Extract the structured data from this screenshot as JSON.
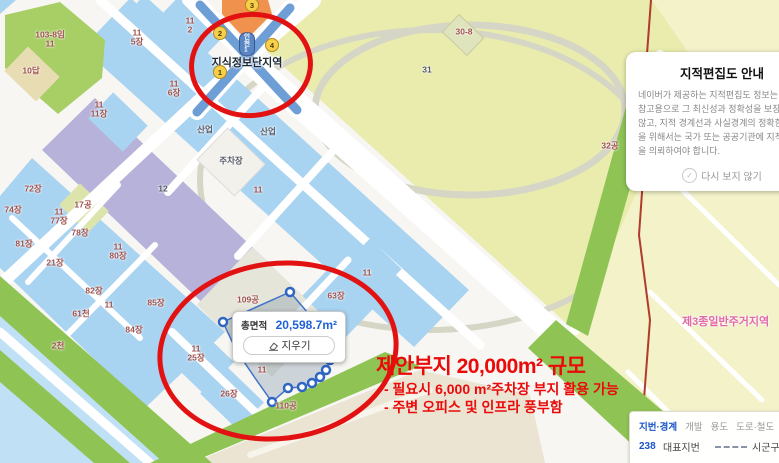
{
  "map": {
    "station": {
      "name": "지식정보단지역",
      "line_badge": "인천1",
      "exits": [
        {
          "n": "3",
          "x": 252,
          "y": 5
        },
        {
          "n": "2",
          "x": 220,
          "y": 33
        },
        {
          "n": "4",
          "x": 272,
          "y": 45
        },
        {
          "n": "1",
          "x": 220,
          "y": 72
        }
      ]
    },
    "zone_label": {
      "text": "제3종일반주거지역",
      "x": 682,
      "y": 313
    },
    "labels": [
      {
        "t": "103-8임\n11",
        "x": 50,
        "y": 40
      },
      {
        "t": "10답",
        "x": 31,
        "y": 71
      },
      {
        "t": "11\n5장",
        "x": 137,
        "y": 38
      },
      {
        "t": "11\n2",
        "x": 190,
        "y": 26
      },
      {
        "t": "11\n6장",
        "x": 174,
        "y": 89
      },
      {
        "t": "11\n11장",
        "x": 99,
        "y": 110
      },
      {
        "t": "12",
        "x": 163,
        "y": 189,
        "c": "dark"
      },
      {
        "t": "산업",
        "x": 205,
        "y": 130,
        "c": "dark"
      },
      {
        "t": "산업",
        "x": 268,
        "y": 132,
        "c": "dark"
      },
      {
        "t": "주차장",
        "x": 231,
        "y": 161,
        "c": "dark"
      },
      {
        "t": "11",
        "x": 258,
        "y": 190
      },
      {
        "t": "72장",
        "x": 33,
        "y": 189
      },
      {
        "t": "74장",
        "x": 13,
        "y": 210
      },
      {
        "t": "17공",
        "x": 83,
        "y": 205
      },
      {
        "t": "11\n77장",
        "x": 59,
        "y": 217
      },
      {
        "t": "78장",
        "x": 80,
        "y": 233
      },
      {
        "t": "81장",
        "x": 24,
        "y": 244
      },
      {
        "t": "21장",
        "x": 55,
        "y": 263
      },
      {
        "t": "11\n80장",
        "x": 118,
        "y": 252
      },
      {
        "t": "82장",
        "x": 94,
        "y": 291
      },
      {
        "t": "85장",
        "x": 156,
        "y": 303
      },
      {
        "t": "11",
        "x": 109,
        "y": 305
      },
      {
        "t": "84장",
        "x": 134,
        "y": 330
      },
      {
        "t": "61천",
        "x": 81,
        "y": 314
      },
      {
        "t": "2천",
        "x": 58,
        "y": 346
      },
      {
        "t": "109공",
        "x": 248,
        "y": 300
      },
      {
        "t": "63장",
        "x": 336,
        "y": 296
      },
      {
        "t": "11",
        "x": 367,
        "y": 273
      },
      {
        "t": "11\n25장",
        "x": 196,
        "y": 354
      },
      {
        "t": "11",
        "x": 262,
        "y": 370
      },
      {
        "t": "26장",
        "x": 229,
        "y": 394
      },
      {
        "t": "110공",
        "x": 286,
        "y": 406
      },
      {
        "t": "30-8",
        "x": 464,
        "y": 32
      },
      {
        "t": "31",
        "x": 427,
        "y": 70,
        "c": "dark"
      },
      {
        "t": "32공",
        "x": 610,
        "y": 146
      }
    ]
  },
  "measure_tooltip": {
    "area_label": "총면적",
    "area_value": "20,598.7m²",
    "clear_label": "지우기"
  },
  "proposal_note": {
    "title": "제안부지 20,000m² 규모",
    "bullets": [
      "- 필요시 6,000 m²주차장 부지 활용 가능",
      "- 주변 오피스 및 인프라 풍부함"
    ]
  },
  "notice_panel": {
    "title": "지적편집도 안내",
    "body": "네이버가 제공하는 지적편집도 정보는 단순 참고용으로 그 최신성과 정확성을 보장하지 않고, 지적 경계선과 사실경계의 정확한 확인을 위해서는 국가 또는 공공기관에 지적측량을 의뢰하여야 합니다.",
    "dismiss_label": "다시 보지 않기"
  },
  "legend_panel": {
    "tabs": [
      "지번·경계",
      "개발",
      "용도",
      "도로·철도",
      "국토계획"
    ],
    "active_tab_index": 0,
    "rows": [
      {
        "num": "238",
        "num_color": "#1a56c9",
        "label": "대표지번",
        "line_style": "dashed",
        "line_color": "#8a93a6",
        "line_label": "시군구경계"
      },
      {
        "num": "239",
        "num_color": "#b03434",
        "label": "지번",
        "line_style": "dotted",
        "line_color": "#7fa3d4",
        "line_label": "행정동경계"
      }
    ]
  },
  "colors": {
    "annotation_red": "#ea0a0a",
    "circle_red": "#e31212",
    "measure_value_blue": "#1f62d6",
    "zone_label_pink": "#e268a8"
  }
}
